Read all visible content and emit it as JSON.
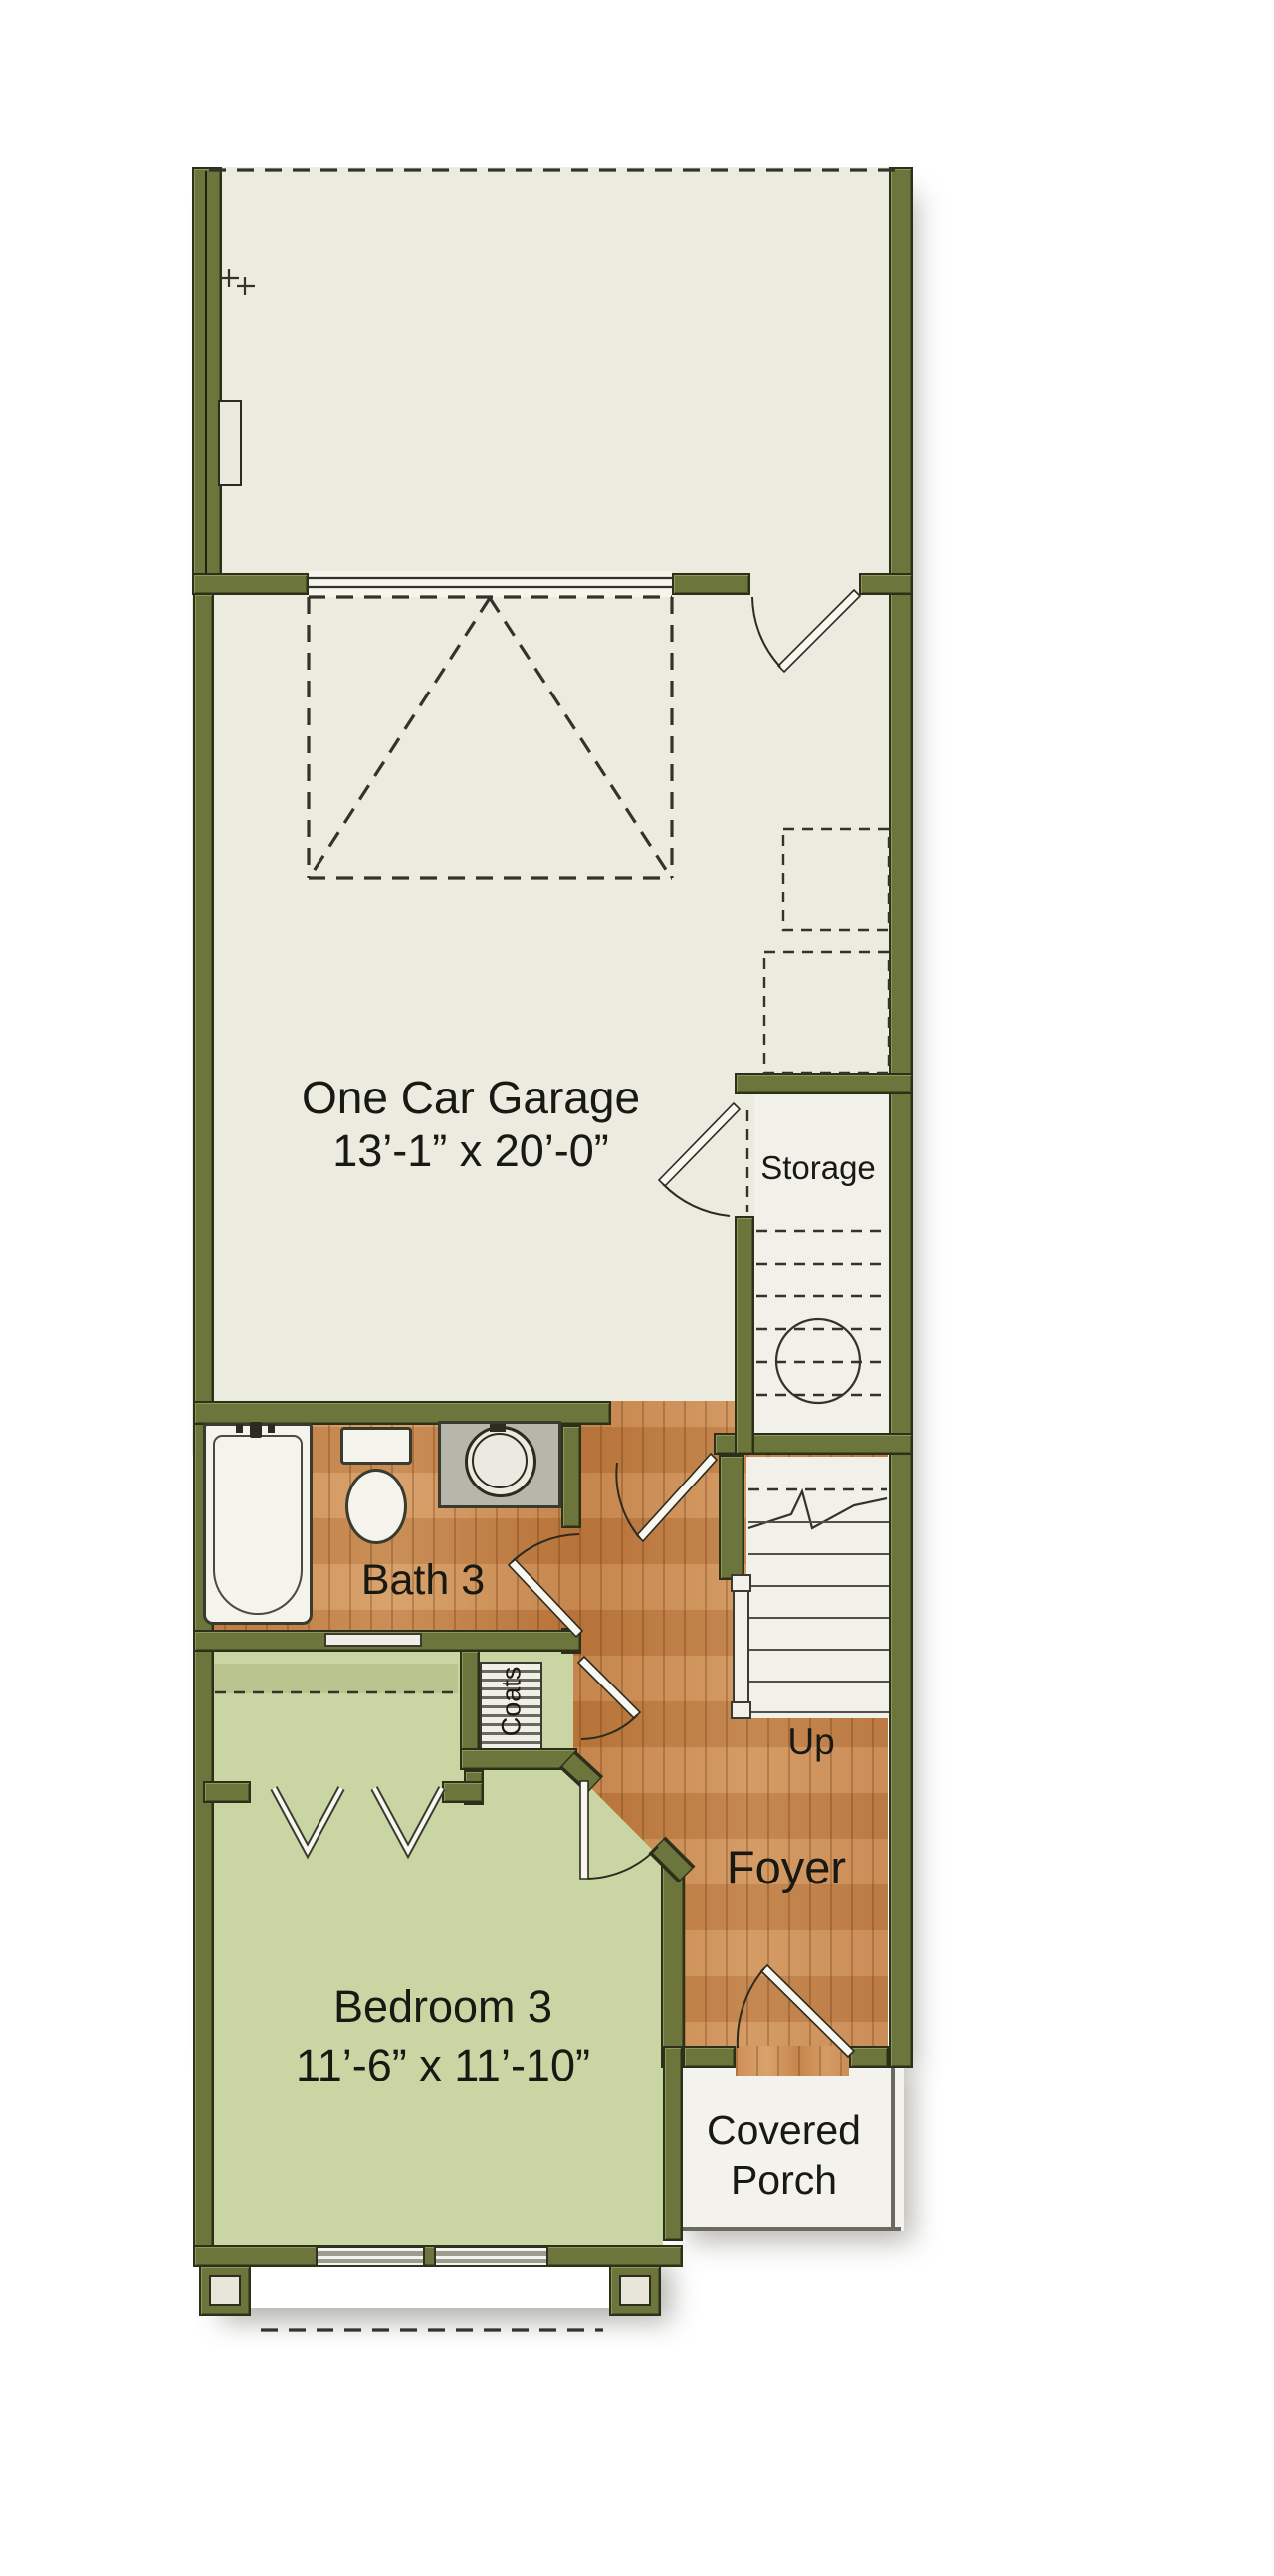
{
  "plan": {
    "type": "first-floor residential floor plan",
    "rooms": {
      "garage": {
        "name": "One Car Garage",
        "dimensions": "13’-1” x 20’-0”"
      },
      "storage": {
        "name": "Storage"
      },
      "bath": {
        "name": "Bath 3"
      },
      "coats": {
        "name": "Coats"
      },
      "stairs": {
        "direction_label": "Up"
      },
      "foyer": {
        "name": "Foyer"
      },
      "bedroom": {
        "name": "Bedroom 3",
        "dimensions": "11’-6” x 11’-10”"
      },
      "porch": {
        "name_line1": "Covered",
        "name_line2": "Porch"
      }
    },
    "colors": {
      "wall": "#6b753c",
      "wall_outline": "#2c301a",
      "wood": "#c8844a",
      "bedroom_green": "#c9d6a3",
      "garage_floor": "#ecebe0",
      "stairs_floor": "#f1f0e9",
      "porch_floor": "#f3f2ec",
      "counter_gray": "#b7b6ab",
      "line": "#33332a"
    }
  }
}
